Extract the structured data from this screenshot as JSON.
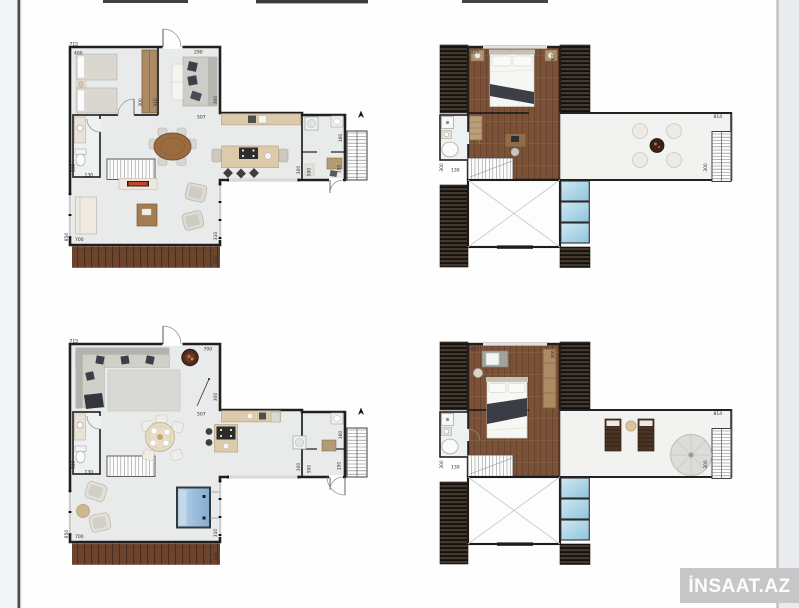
{
  "watermark": {
    "text": "İNSAAT.AZ",
    "background": "#c7c7c7",
    "text_color": "#fdfdfd"
  },
  "palette": {
    "page_background": "#ffffff",
    "margin_background": "#edeff2",
    "wall": "#1f1f1f",
    "floor_light": "#e9ebeb",
    "wood_floor": "#7b5237",
    "deck_wood": "#6d452e",
    "roof_slats": "#44392e",
    "skylight_blue": "#a7cfe4",
    "jacuzzi_blue": "#8fb6d6",
    "counter_beige": "#dccbab",
    "fireplace_red": "#c94427"
  },
  "plans": {
    "ground_a": {
      "dims": {
        "top": "715",
        "bedroom": "400",
        "living": "290",
        "wardrobe_a": "300",
        "wardrobe_b": "310",
        "living_side": "300",
        "pass": "507",
        "bath_side": "300",
        "bath": "130",
        "deck": "700",
        "deck_side": "850",
        "lounge_side": "310",
        "deck_edge": "100",
        "utility_side": "160",
        "u1": "300",
        "u2": "590",
        "u3": "150"
      }
    },
    "upper_b": {
      "dims": {
        "room": "425",
        "room_side": "300",
        "bath_side": "300",
        "bath": "130",
        "terrace": "814",
        "terrace_side": "300"
      }
    },
    "ground_c": {
      "dims": {
        "top": "715",
        "living": "700",
        "living_side": "300",
        "pass": "507",
        "bath_side": "300",
        "bath": "130",
        "deck": "700",
        "deck_side": "850",
        "lounge_side": "310",
        "deck_edge": "100",
        "utility_side": "160",
        "u1": "300",
        "u2": "590",
        "u3": "150"
      }
    },
    "upper_d": {
      "dims": {
        "room": "425",
        "room_side": "300",
        "bath_side": "300",
        "bath": "130",
        "terrace": "814",
        "terrace_side": "300"
      }
    }
  }
}
